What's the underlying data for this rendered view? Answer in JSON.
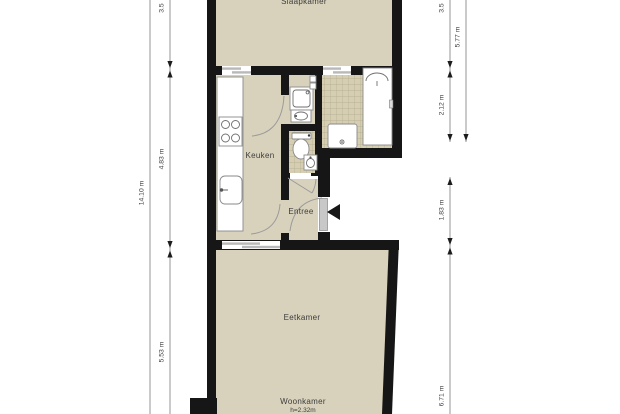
{
  "plan": {
    "type": "apartment-floor-plan",
    "rooms": {
      "slaapkamer": {
        "label": "Slaapkamer"
      },
      "keuken": {
        "label": "Keuken"
      },
      "entree": {
        "label": "Entree"
      },
      "eetkamer": {
        "label": "Eetkamer"
      },
      "woonkamer": {
        "label": "Woonkamer",
        "height_note": "h=2.32m"
      }
    },
    "fixtures": [
      "kitchen-counter",
      "cooktop",
      "kitchen-sink",
      "washing-machine",
      "washbasin",
      "wall-meters",
      "toilet",
      "hand-basin",
      "shower-tray",
      "shower-cabin",
      "entrance-door",
      "sliding-doors"
    ],
    "entrance_marker": "black-triangle-pointing-left"
  },
  "dimensions": {
    "left_outer": {
      "label": "14.10 m"
    },
    "left_inner": {
      "segments": [
        {
          "label": "3.5"
        },
        {
          "label": "4.83 m"
        },
        {
          "label": "5.53 m"
        }
      ]
    },
    "right_inner": {
      "segments": [
        {
          "label": "3.5"
        },
        {
          "label": "2.12 m"
        },
        {
          "label": "1.83 m"
        },
        {
          "label": "6.71 m"
        }
      ]
    },
    "right_outer": {
      "label": "5.77 m"
    }
  },
  "colors": {
    "floor": "#d8d2bc",
    "wall": "#161616",
    "tile_bg": "#d5ceb2",
    "tile_line": "#b3aa8c",
    "fixture_stroke": "#8a8a8a",
    "dim_line": "#7a7a7a",
    "dim_text": "#3a3a3a",
    "label_text": "#3c3c3c",
    "door_arc": "#9a9a9a",
    "entrance_door": "#c8c8c8"
  }
}
